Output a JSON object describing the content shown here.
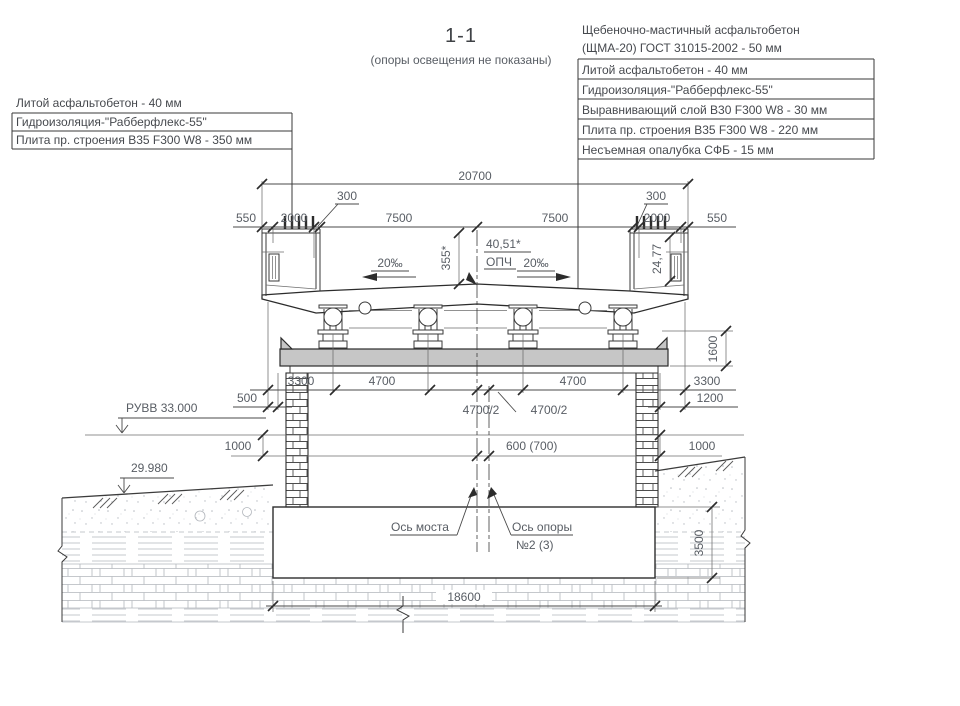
{
  "title": "1-1",
  "subtitle": "(опоры освещения не показаны)",
  "left_layers": {
    "rows": [
      "Литой асфальтобетон - 40 мм",
      "Гидроизоляция-\"Рабберфлекс-55\"",
      "Плита пр. строения  В35 F300 W8  - 350 мм"
    ]
  },
  "right_layers": {
    "rows": [
      "Щебеночно-мастичный асфальтобетон",
      "(ЩМА-20) ГОСТ 31015-2002 - 50 мм",
      "Литой асфальтобетон - 40 мм",
      "Гидроизоляция-\"Рабберфлекс-55\"",
      "Выравнивающий слой  В30 F300 W8 - 30 мм",
      "Плита пр. строения  В35 F300 W8 - 220 мм",
      "Несъемная опалубка СФБ - 15 мм"
    ]
  },
  "dimensions": {
    "total_width": "20700",
    "left_550": "550",
    "left_2000": "2000",
    "left_300": "300",
    "left_7500": "7500",
    "right_7500": "7500",
    "right_300": "300",
    "right_2000": "2000",
    "right_550": "550",
    "girder_3300_left": "3300",
    "girder_4700_left": "4700",
    "girder_4700_right": "4700",
    "girder_3300_right": "3300",
    "half_4700_left": "4700/2",
    "half_4700_right": "4700/2",
    "cap_500": "500",
    "cap_1200": "1200",
    "cap_height_1600": "1600",
    "level_1000_left": "1000",
    "level_1000_right": "1000",
    "axis_offset": "600 (700)",
    "foundation_height": "3500",
    "foundation_width": "18600",
    "deck_355": "355*",
    "deck_2477": "24,77"
  },
  "annotations": {
    "water_level": "РУВВ 33.000",
    "ground_level": "29.980",
    "road_elevation": "40,51*",
    "opch": "ОПЧ",
    "slope_left": "20‰",
    "slope_right": "20‰",
    "bridge_axis": "Ось моста",
    "pier_axis_line1": "Ось опоры",
    "pier_axis_line2": "№2 (3)"
  }
}
